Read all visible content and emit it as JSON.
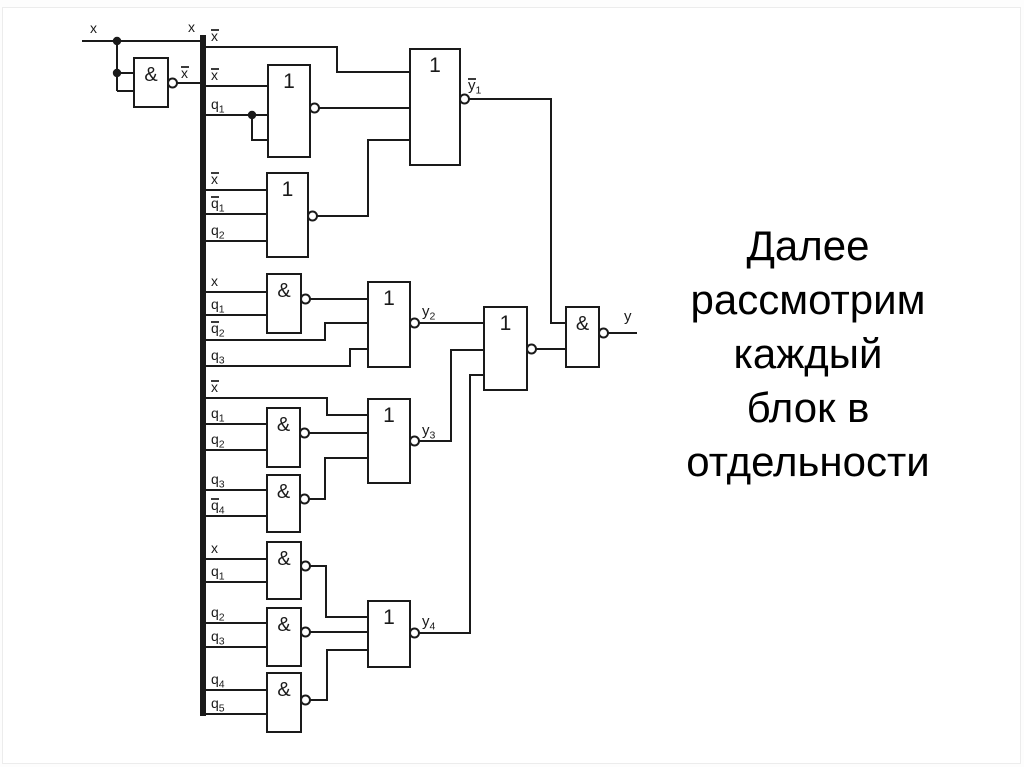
{
  "caption": {
    "text": "Далее рассмотрим каждый блок в отдельности",
    "lines": [
      "Далее",
      "рассмотрим",
      "каждый",
      "блок в",
      "отдельности"
    ],
    "color": "#000000"
  },
  "diagram": {
    "stroke_color": "#1a1a1a",
    "background": "#ffffff",
    "bus": {
      "signal": "x",
      "x": 200,
      "y1": 35,
      "y2": 716,
      "width": 6
    },
    "gates": [
      {
        "id": "nand-x",
        "symbol": "&",
        "x": 134,
        "y": 58,
        "w": 34,
        "h": 49,
        "out_y": 83
      },
      {
        "id": "or-1",
        "symbol": "1",
        "x": 268,
        "y": 65,
        "w": 42,
        "h": 92,
        "out_y": 108
      },
      {
        "id": "or-y1",
        "symbol": "1",
        "x": 410,
        "y": 49,
        "w": 50,
        "h": 116,
        "out_y": 99
      },
      {
        "id": "or-2",
        "symbol": "1",
        "x": 267,
        "y": 173,
        "w": 41,
        "h": 84,
        "out_y": 216
      },
      {
        "id": "and-y2",
        "symbol": "&",
        "x": 267,
        "y": 274,
        "w": 34,
        "h": 59,
        "out_y": 299
      },
      {
        "id": "or-y2",
        "symbol": "1",
        "x": 368,
        "y": 282,
        "w": 42,
        "h": 85,
        "out_y": 323
      },
      {
        "id": "and-y3-1",
        "symbol": "&",
        "x": 267,
        "y": 408,
        "w": 33,
        "h": 59,
        "out_y": 433
      },
      {
        "id": "and-y3-2",
        "symbol": "&",
        "x": 267,
        "y": 475,
        "w": 33,
        "h": 57,
        "out_y": 499
      },
      {
        "id": "or-y3",
        "symbol": "1",
        "x": 368,
        "y": 399,
        "w": 42,
        "h": 84,
        "out_y": 441
      },
      {
        "id": "and-y4-1",
        "symbol": "&",
        "x": 267,
        "y": 542,
        "w": 34,
        "h": 57,
        "out_y": 566
      },
      {
        "id": "and-y4-2",
        "symbol": "&",
        "x": 267,
        "y": 608,
        "w": 34,
        "h": 58,
        "out_y": 632
      },
      {
        "id": "and-y4-3",
        "symbol": "&",
        "x": 267,
        "y": 673,
        "w": 34,
        "h": 59,
        "out_y": 700
      },
      {
        "id": "or-y4",
        "symbol": "1",
        "x": 368,
        "y": 601,
        "w": 42,
        "h": 66,
        "out_y": 633
      },
      {
        "id": "or-y",
        "symbol": "1",
        "x": 484,
        "y": 307,
        "w": 43,
        "h": 83,
        "out_y": 349
      },
      {
        "id": "and-y",
        "symbol": "&",
        "x": 566,
        "y": 307,
        "w": 33,
        "h": 60,
        "out_y": 333
      }
    ],
    "wires": [
      {
        "id": "x-input",
        "pts": [
          [
            82,
            41
          ],
          [
            200,
            41
          ]
        ]
      },
      {
        "id": "x-branch-vertical",
        "pts": [
          [
            117,
            41
          ],
          [
            117,
            91
          ]
        ]
      },
      {
        "id": "x-to-nand-in1",
        "pts": [
          [
            117,
            73
          ],
          [
            134,
            73
          ]
        ]
      },
      {
        "id": "x-to-nand-in2",
        "pts": [
          [
            117,
            91
          ],
          [
            134,
            91
          ]
        ]
      },
      {
        "id": "nand-out-to-bus",
        "pts": [
          [
            168,
            83
          ],
          [
            200,
            83
          ]
        ]
      },
      {
        "id": "tap-xbar-to-or-y1",
        "pts": [
          [
            206,
            47
          ],
          [
            337,
            47
          ],
          [
            337,
            72
          ],
          [
            410,
            72
          ]
        ]
      },
      {
        "id": "tap-xbar-to-or-1",
        "pts": [
          [
            206,
            86
          ],
          [
            268,
            86
          ]
        ]
      },
      {
        "id": "tap-q1-to-or-1",
        "pts": [
          [
            206,
            115
          ],
          [
            268,
            115
          ]
        ]
      },
      {
        "id": "q1-branch-to-or-1",
        "pts": [
          [
            252,
            115
          ],
          [
            252,
            140
          ],
          [
            268,
            140
          ]
        ]
      },
      {
        "id": "or-1-out",
        "pts": [
          [
            310,
            108
          ],
          [
            410,
            108
          ]
        ]
      },
      {
        "id": "tap-xbar-to-or-2",
        "pts": [
          [
            206,
            190
          ],
          [
            267,
            190
          ]
        ]
      },
      {
        "id": "tap-qbar1-to-or-2",
        "pts": [
          [
            206,
            214
          ],
          [
            267,
            214
          ]
        ]
      },
      {
        "id": "tap-q2-to-or-2",
        "pts": [
          [
            206,
            241
          ],
          [
            267,
            241
          ]
        ]
      },
      {
        "id": "or-2-out",
        "pts": [
          [
            308,
            216
          ],
          [
            368,
            216
          ],
          [
            368,
            140
          ],
          [
            410,
            140
          ]
        ]
      },
      {
        "id": "ybar1-to-and-y",
        "pts": [
          [
            460,
            99
          ],
          [
            551,
            99
          ],
          [
            551,
            323
          ],
          [
            566,
            323
          ]
        ]
      },
      {
        "id": "tap-x-to-and-y2",
        "pts": [
          [
            206,
            292
          ],
          [
            267,
            292
          ]
        ]
      },
      {
        "id": "tap-q1-to-and-y2",
        "pts": [
          [
            206,
            315
          ],
          [
            267,
            315
          ]
        ]
      },
      {
        "id": "and-y2-out",
        "pts": [
          [
            301,
            299
          ],
          [
            368,
            299
          ]
        ]
      },
      {
        "id": "tap-qbar2-to-or-y2",
        "pts": [
          [
            206,
            340
          ],
          [
            325,
            340
          ],
          [
            325,
            323
          ],
          [
            368,
            323
          ]
        ]
      },
      {
        "id": "tap-q3-to-or-y2",
        "pts": [
          [
            206,
            366
          ],
          [
            350,
            366
          ],
          [
            350,
            349
          ],
          [
            368,
            349
          ]
        ]
      },
      {
        "id": "y2-to-or-y",
        "pts": [
          [
            410,
            323
          ],
          [
            484,
            323
          ]
        ]
      },
      {
        "id": "tap-xbar-to-or-y3",
        "pts": [
          [
            206,
            398
          ],
          [
            327,
            398
          ],
          [
            327,
            415
          ],
          [
            368,
            415
          ]
        ]
      },
      {
        "id": "tap-q1-to-and-y3-1",
        "pts": [
          [
            206,
            424
          ],
          [
            267,
            424
          ]
        ]
      },
      {
        "id": "tap-q2-to-and-y3-1",
        "pts": [
          [
            206,
            450
          ],
          [
            267,
            450
          ]
        ]
      },
      {
        "id": "and-y3-1-out",
        "pts": [
          [
            300,
            433
          ],
          [
            368,
            433
          ]
        ]
      },
      {
        "id": "tap-q3-to-and-y3-2",
        "pts": [
          [
            206,
            490
          ],
          [
            267,
            490
          ]
        ]
      },
      {
        "id": "tap-qbar4-to-and-y3-2",
        "pts": [
          [
            206,
            516
          ],
          [
            267,
            516
          ]
        ]
      },
      {
        "id": "and-y3-2-out",
        "pts": [
          [
            300,
            499
          ],
          [
            325,
            499
          ],
          [
            325,
            458
          ],
          [
            368,
            458
          ]
        ]
      },
      {
        "id": "y3-to-or-y",
        "pts": [
          [
            410,
            441
          ],
          [
            451,
            441
          ],
          [
            451,
            350
          ],
          [
            484,
            350
          ]
        ]
      },
      {
        "id": "tap-x-to-and-y4-1",
        "pts": [
          [
            206,
            559
          ],
          [
            267,
            559
          ]
        ]
      },
      {
        "id": "tap-q1-to-and-y4-1",
        "pts": [
          [
            206,
            582
          ],
          [
            267,
            582
          ]
        ]
      },
      {
        "id": "and-y4-1-out",
        "pts": [
          [
            301,
            566
          ],
          [
            326,
            566
          ],
          [
            326,
            617
          ],
          [
            368,
            617
          ]
        ]
      },
      {
        "id": "tap-q2-to-and-y4-2",
        "pts": [
          [
            206,
            623
          ],
          [
            267,
            623
          ]
        ]
      },
      {
        "id": "tap-q3-to-and-y4-2",
        "pts": [
          [
            206,
            647
          ],
          [
            267,
            647
          ]
        ]
      },
      {
        "id": "and-y4-2-out",
        "pts": [
          [
            301,
            632
          ],
          [
            368,
            632
          ]
        ]
      },
      {
        "id": "tap-q4-to-and-y4-3",
        "pts": [
          [
            206,
            690
          ],
          [
            267,
            690
          ]
        ]
      },
      {
        "id": "tap-q5-to-and-y4-3",
        "pts": [
          [
            206,
            714
          ],
          [
            267,
            714
          ]
        ]
      },
      {
        "id": "and-y4-3-out",
        "pts": [
          [
            301,
            700
          ],
          [
            327,
            700
          ],
          [
            327,
            650
          ],
          [
            368,
            650
          ]
        ]
      },
      {
        "id": "y4-to-or-y",
        "pts": [
          [
            410,
            633
          ],
          [
            470,
            633
          ],
          [
            470,
            375
          ],
          [
            484,
            375
          ]
        ]
      },
      {
        "id": "or-y-out",
        "pts": [
          [
            527,
            349
          ],
          [
            566,
            349
          ]
        ]
      },
      {
        "id": "y-output",
        "pts": [
          [
            599,
            333
          ],
          [
            637,
            333
          ]
        ]
      }
    ],
    "dots": [
      [
        117,
        41
      ],
      [
        117,
        73
      ],
      [
        252,
        115
      ]
    ],
    "labels": [
      {
        "name": "input-x",
        "x": 90,
        "y": 33,
        "base": "x"
      },
      {
        "name": "bus-x",
        "x": 195,
        "y": 32,
        "base": "x",
        "anchor": "end"
      },
      {
        "name": "nand-out-xbar",
        "x": 181,
        "y": 78,
        "base": "x",
        "bar": true
      },
      {
        "name": "tap-xbar-1",
        "x": 211,
        "y": 41,
        "base": "x",
        "bar": true
      },
      {
        "name": "tap-xbar-2",
        "x": 211,
        "y": 80,
        "base": "x",
        "bar": true
      },
      {
        "name": "tap-q1-1",
        "x": 211,
        "y": 109,
        "base": "q",
        "sub": "1"
      },
      {
        "name": "tap-xbar-3",
        "x": 211,
        "y": 184,
        "base": "x",
        "bar": true
      },
      {
        "name": "tap-qbar1",
        "x": 211,
        "y": 208,
        "base": "q",
        "bar": true,
        "sub": "1"
      },
      {
        "name": "tap-q2-1",
        "x": 211,
        "y": 235,
        "base": "q",
        "sub": "2"
      },
      {
        "name": "tap-x-1",
        "x": 211,
        "y": 286,
        "base": "x"
      },
      {
        "name": "tap-q1-2",
        "x": 211,
        "y": 309,
        "base": "q",
        "sub": "1"
      },
      {
        "name": "tap-qbar2",
        "x": 211,
        "y": 333,
        "base": "q",
        "bar": true,
        "sub": "2"
      },
      {
        "name": "tap-q3-1",
        "x": 211,
        "y": 360,
        "base": "q",
        "sub": "3"
      },
      {
        "name": "tap-xbar-4",
        "x": 211,
        "y": 392,
        "base": "x",
        "bar": true
      },
      {
        "name": "tap-q1-3",
        "x": 211,
        "y": 418,
        "base": "q",
        "sub": "1"
      },
      {
        "name": "tap-q2-2",
        "x": 211,
        "y": 444,
        "base": "q",
        "sub": "2"
      },
      {
        "name": "tap-q3-2",
        "x": 211,
        "y": 484,
        "base": "q",
        "sub": "3"
      },
      {
        "name": "tap-qbar4",
        "x": 211,
        "y": 510,
        "base": "q",
        "bar": true,
        "sub": "4"
      },
      {
        "name": "tap-x-2",
        "x": 211,
        "y": 553,
        "base": "x"
      },
      {
        "name": "tap-q1-4",
        "x": 211,
        "y": 576,
        "base": "q",
        "sub": "1"
      },
      {
        "name": "tap-q2-3",
        "x": 211,
        "y": 617,
        "base": "q",
        "sub": "2"
      },
      {
        "name": "tap-q3-3",
        "x": 211,
        "y": 641,
        "base": "q",
        "sub": "3"
      },
      {
        "name": "tap-q4",
        "x": 211,
        "y": 684,
        "base": "q",
        "sub": "4"
      },
      {
        "name": "tap-q5",
        "x": 211,
        "y": 708,
        "base": "q",
        "sub": "5"
      },
      {
        "name": "out-ybar1",
        "x": 468,
        "y": 90,
        "base": "y",
        "bar": true,
        "sub": "1",
        "size": 15
      },
      {
        "name": "out-y2",
        "x": 422,
        "y": 316,
        "base": "y",
        "sub": "2",
        "size": 15
      },
      {
        "name": "out-y3",
        "x": 422,
        "y": 435,
        "base": "y",
        "sub": "3",
        "size": 15
      },
      {
        "name": "out-y4",
        "x": 422,
        "y": 626,
        "base": "y",
        "sub": "4",
        "size": 15
      },
      {
        "name": "out-y",
        "x": 624,
        "y": 321,
        "base": "y",
        "size": 15
      }
    ]
  }
}
